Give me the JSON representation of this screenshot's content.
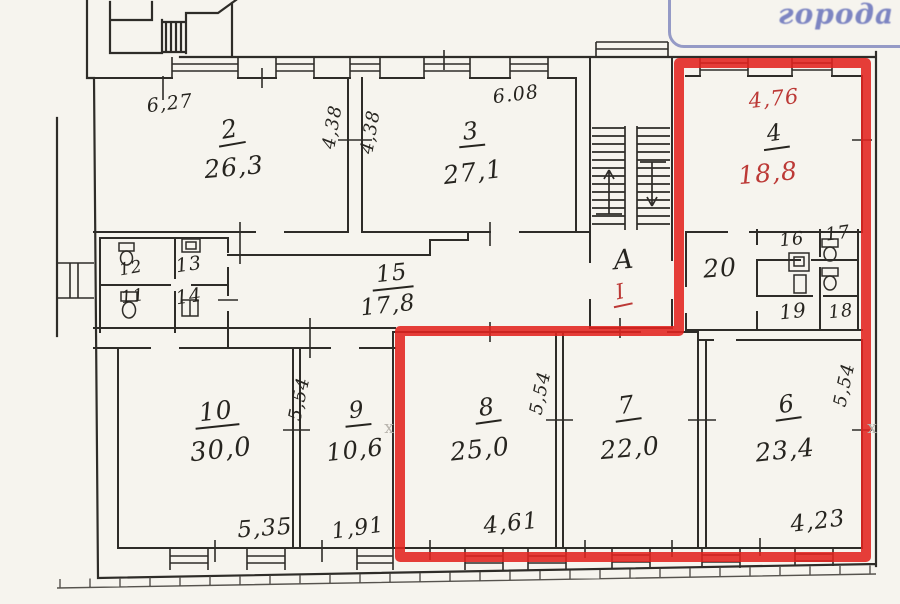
{
  "stamp": {
    "text": "города"
  },
  "watermark": {
    "char": "х"
  },
  "rooms": {
    "r2": {
      "num": "2",
      "area": "26,3"
    },
    "r3": {
      "num": "3",
      "area": "27,1"
    },
    "r4": {
      "num": "4",
      "area": "18,8",
      "width_dim": "4,76"
    },
    "r6": {
      "num": "6",
      "area": "23,4"
    },
    "r7": {
      "num": "7",
      "area": "22,0"
    },
    "r8": {
      "num": "8",
      "area": "25,0"
    },
    "r9": {
      "num": "9",
      "area": "10,6"
    },
    "r10": {
      "num": "10",
      "area": "30,0"
    },
    "r11": {
      "num": "11"
    },
    "r12": {
      "num": "12"
    },
    "r13": {
      "num": "13"
    },
    "r14": {
      "num": "14"
    },
    "r15": {
      "num": "15",
      "area": "17,8"
    },
    "r16": {
      "num": "16"
    },
    "r17": {
      "num": "17"
    },
    "r18": {
      "num": "18"
    },
    "r19": {
      "num": "19"
    },
    "r20": {
      "num": "20"
    },
    "stair": {
      "letter": "А",
      "entrance": "I"
    }
  },
  "dimensions": {
    "top_room2": "6,27",
    "side_room2": "4,38",
    "side_room3": "4,38",
    "top_room3": "6.08",
    "room10_side": "5,54",
    "room10_bottom": "5,35",
    "room9_bottom": "1,91",
    "room8_side": "5,54",
    "room8_bottom": "4,61",
    "room6_side": "5,54",
    "room6_bottom": "4,23"
  },
  "colors": {
    "highlight": "#e2231f",
    "red_ink": "#bc3936",
    "stamp_blue": "#7d85c2",
    "ink": "#2e2c28",
    "paper": "#f6f4ee"
  }
}
